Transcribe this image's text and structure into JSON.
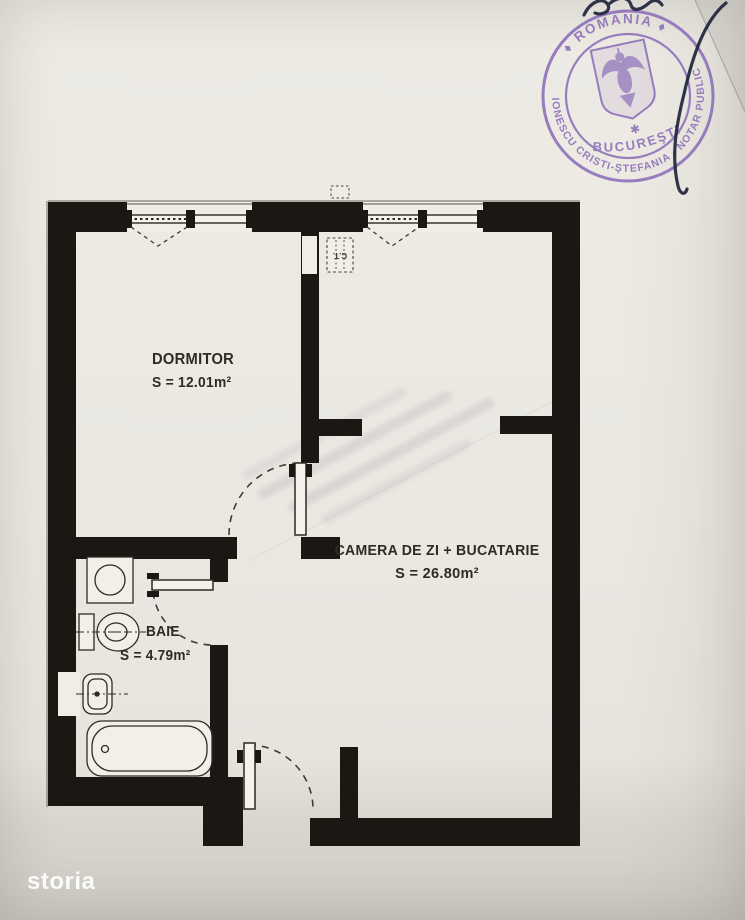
{
  "plan": {
    "wall_color": "#1b1814",
    "rooms": [
      {
        "name": "DORMITOR",
        "area": "S = 12.01m²"
      },
      {
        "name": "CAMERA DE ZI + BUCATARIE",
        "area": "S = 26.80m²"
      },
      {
        "name": "BAIE",
        "area": "S = 4.79m²"
      }
    ],
    "shaft_label": "C.T.",
    "fixture_icons": [
      "washing-machine",
      "toilet",
      "sink",
      "bathtub"
    ],
    "window_count": 2,
    "door_count": 3
  },
  "stamp": {
    "ring_top": "♦ ROMANIA ♦",
    "ring_bottom": "IONESCU CRISTI-ŞTEFANIA - NOTAR PUBLIC",
    "center_city": "BUCUREŞTI",
    "center_star": "✱",
    "ink_color": "#8c6eb9",
    "signature_ink": "#1c2038"
  },
  "watermark": {
    "brand": "storia"
  }
}
